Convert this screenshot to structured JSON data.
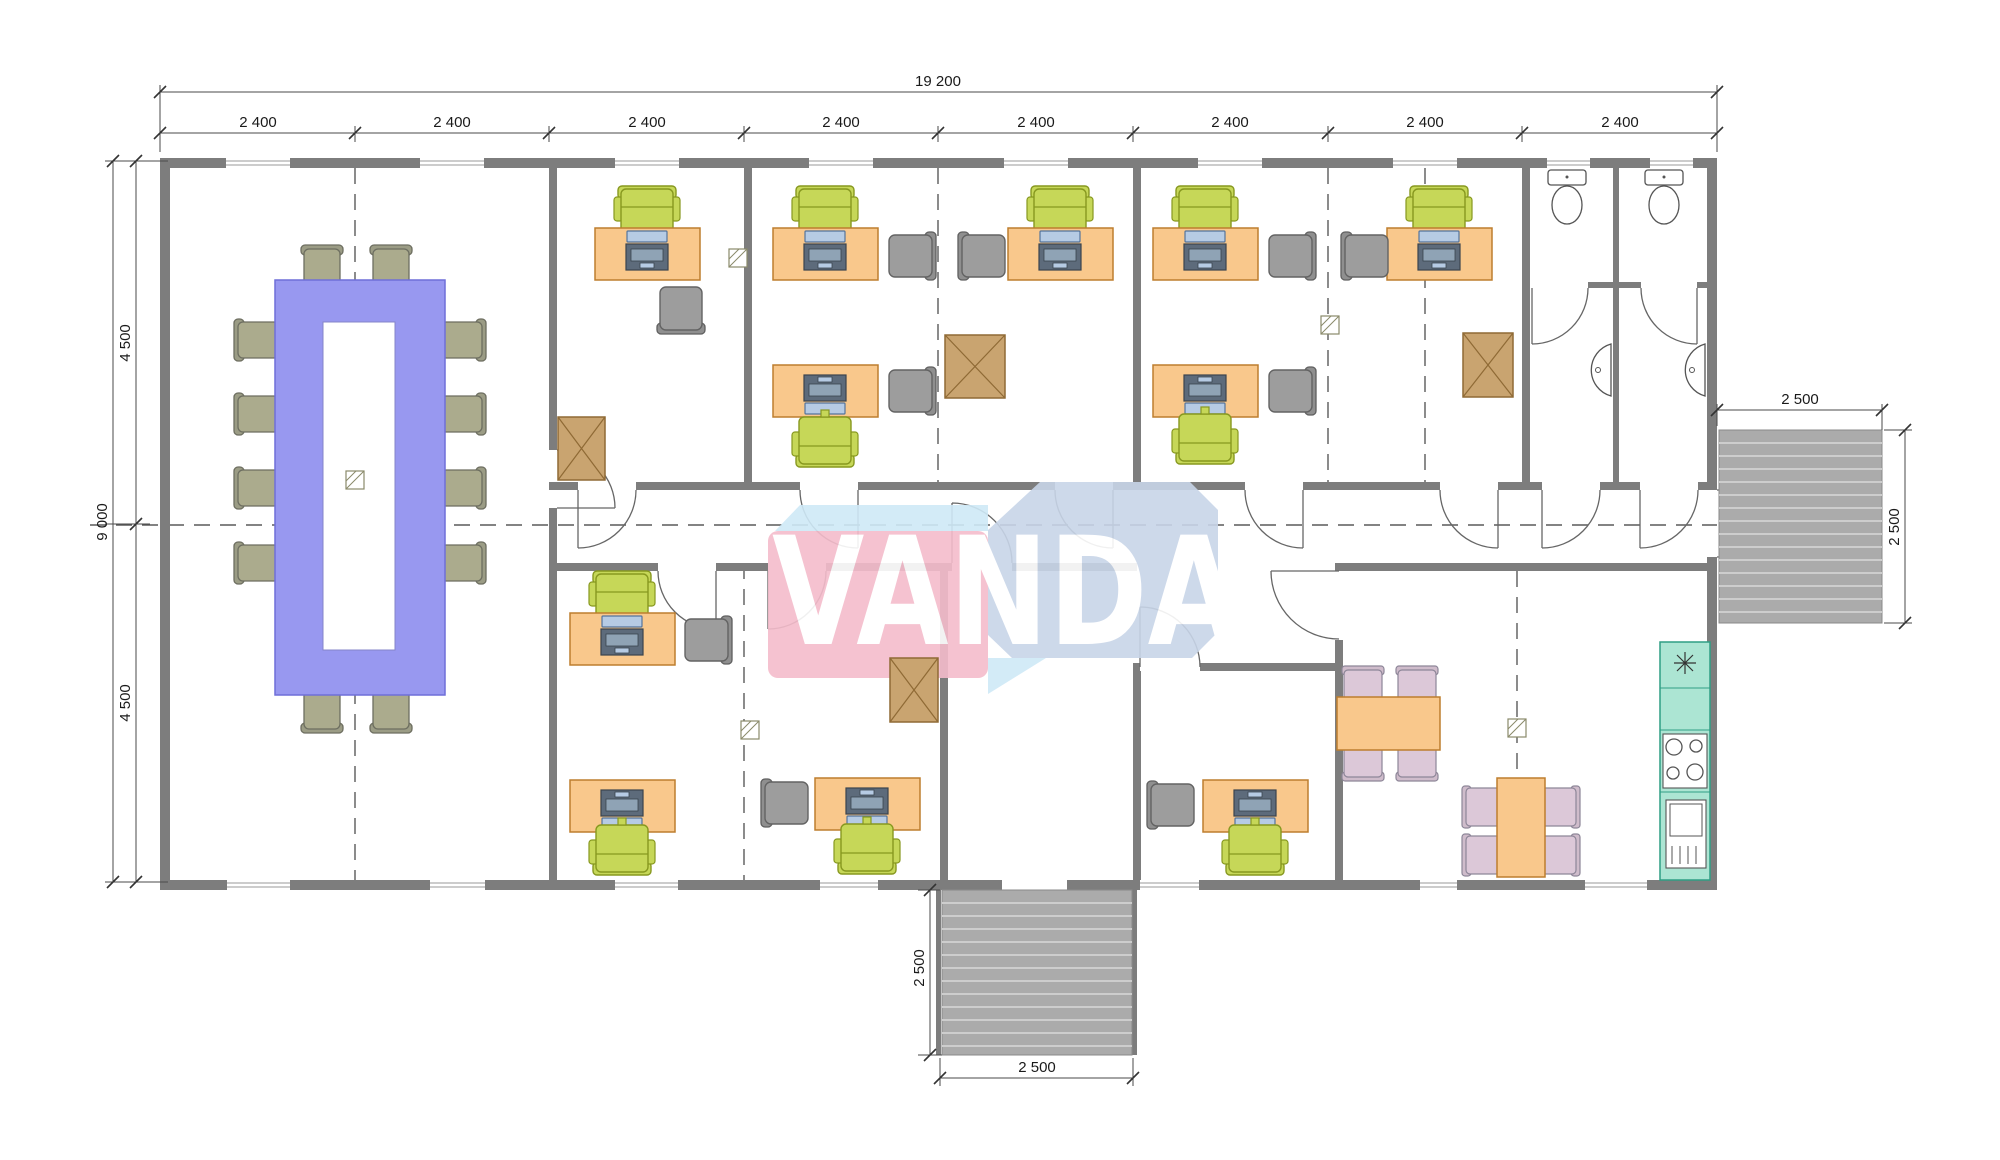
{
  "watermark": {
    "text": "VANDA",
    "pink": "#f4bccb",
    "blue": "#c8d5e8",
    "light_blue": "#cfe9f7"
  },
  "dimensions": {
    "overall_width": "19 200",
    "modules": [
      "2 400",
      "2 400",
      "2 400",
      "2 400",
      "2 400",
      "2 400",
      "2 400",
      "2 400"
    ],
    "left_total": "9 000",
    "left_top": "4 500",
    "left_bottom": "4 500",
    "deck_width": "2 500",
    "deck_height": "2 500",
    "porch_height": "2 500",
    "porch_width": "2 500"
  },
  "colors": {
    "wall": "#7d7d7d",
    "desk": "#f9c88c",
    "office_chair_green": "#c6d758",
    "guest_chair_gray": "#9d9d9d",
    "conference_table_purple": "#9898f0",
    "conference_chair_olive": "#abab8d",
    "dining_chair_lavender": "#dcc8d8",
    "kitchen_counter_teal": "#ace5d3",
    "crate_brown": "#c9a470",
    "deck_gray": "#ababab"
  },
  "icons": {
    "conference-table-icon": "hollow rectangle table with 12 chairs",
    "desk-icon": "orange desk with computer",
    "office-chair-icon": "green swivel chair",
    "guest-chair-icon": "gray side chair",
    "crate-icon": "box with X",
    "toilet-icon": "tank and bowl",
    "sink-icon": "half-round basin",
    "stove-icon": "4-burner cooktop",
    "fridge-icon": "refrigerator with vents",
    "dining-table-icon": "orange table with 4 chairs",
    "stairs-icon": "hatched landing",
    "axis-marker-icon": "small hatched square on grid line"
  }
}
